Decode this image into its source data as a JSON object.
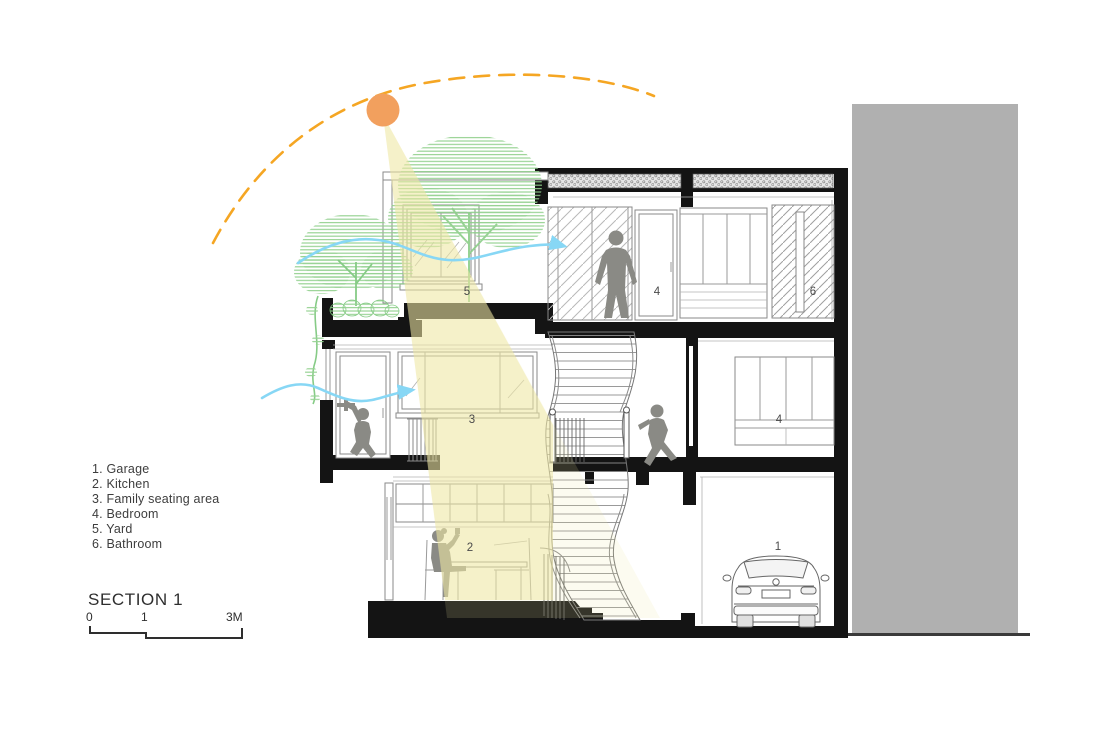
{
  "drawing": {
    "title": "SECTION 1",
    "legend": [
      "1. Garage",
      "2. Kitchen",
      "3. Family seating area",
      "4. Bedroom",
      "5. Yard",
      "6. Bathroom"
    ],
    "scale_bar": {
      "start": "0",
      "mid": "1",
      "end": "3M"
    },
    "room_numbers": {
      "garage": "1",
      "kitchen": "2",
      "family_seating": "3",
      "bedroom_middle": "4",
      "bedroom_upper": "4",
      "yard": "5",
      "bathroom": "6"
    }
  },
  "colors": {
    "sun": "#F2A05E",
    "sun_path": "#F5A623",
    "wind": "#87D7F5",
    "light_beam": "#EFE7A3",
    "tree": "#8FCF8B",
    "silhouette": "#8A8A85",
    "neighbor_building": "#B0B0B0",
    "wall": "#141414"
  }
}
